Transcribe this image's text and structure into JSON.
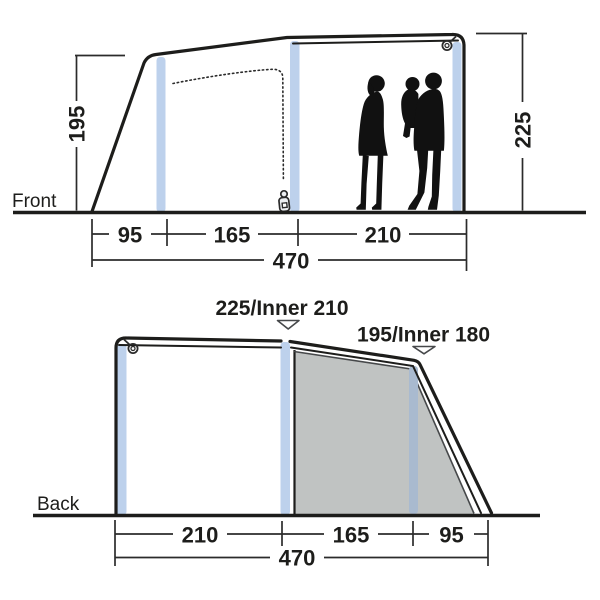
{
  "title": "Tent dimension diagram",
  "front_view": {
    "label": "Front",
    "height_left": "195",
    "height_right": "225",
    "segment_widths": [
      "95",
      "165",
      "210"
    ],
    "total_width": "470"
  },
  "back_view": {
    "label": "Back",
    "peak_label_inner_1": "225/Inner 210",
    "peak_label_inner_2": "195/Inner 180",
    "segment_widths": [
      "210",
      "165",
      "95"
    ],
    "total_width": "470"
  },
  "colors": {
    "pole": "#bdd1ec",
    "pole_shaded": "#a9bacf",
    "panel": "#c0c3c2",
    "line": "#1d1d1b"
  }
}
